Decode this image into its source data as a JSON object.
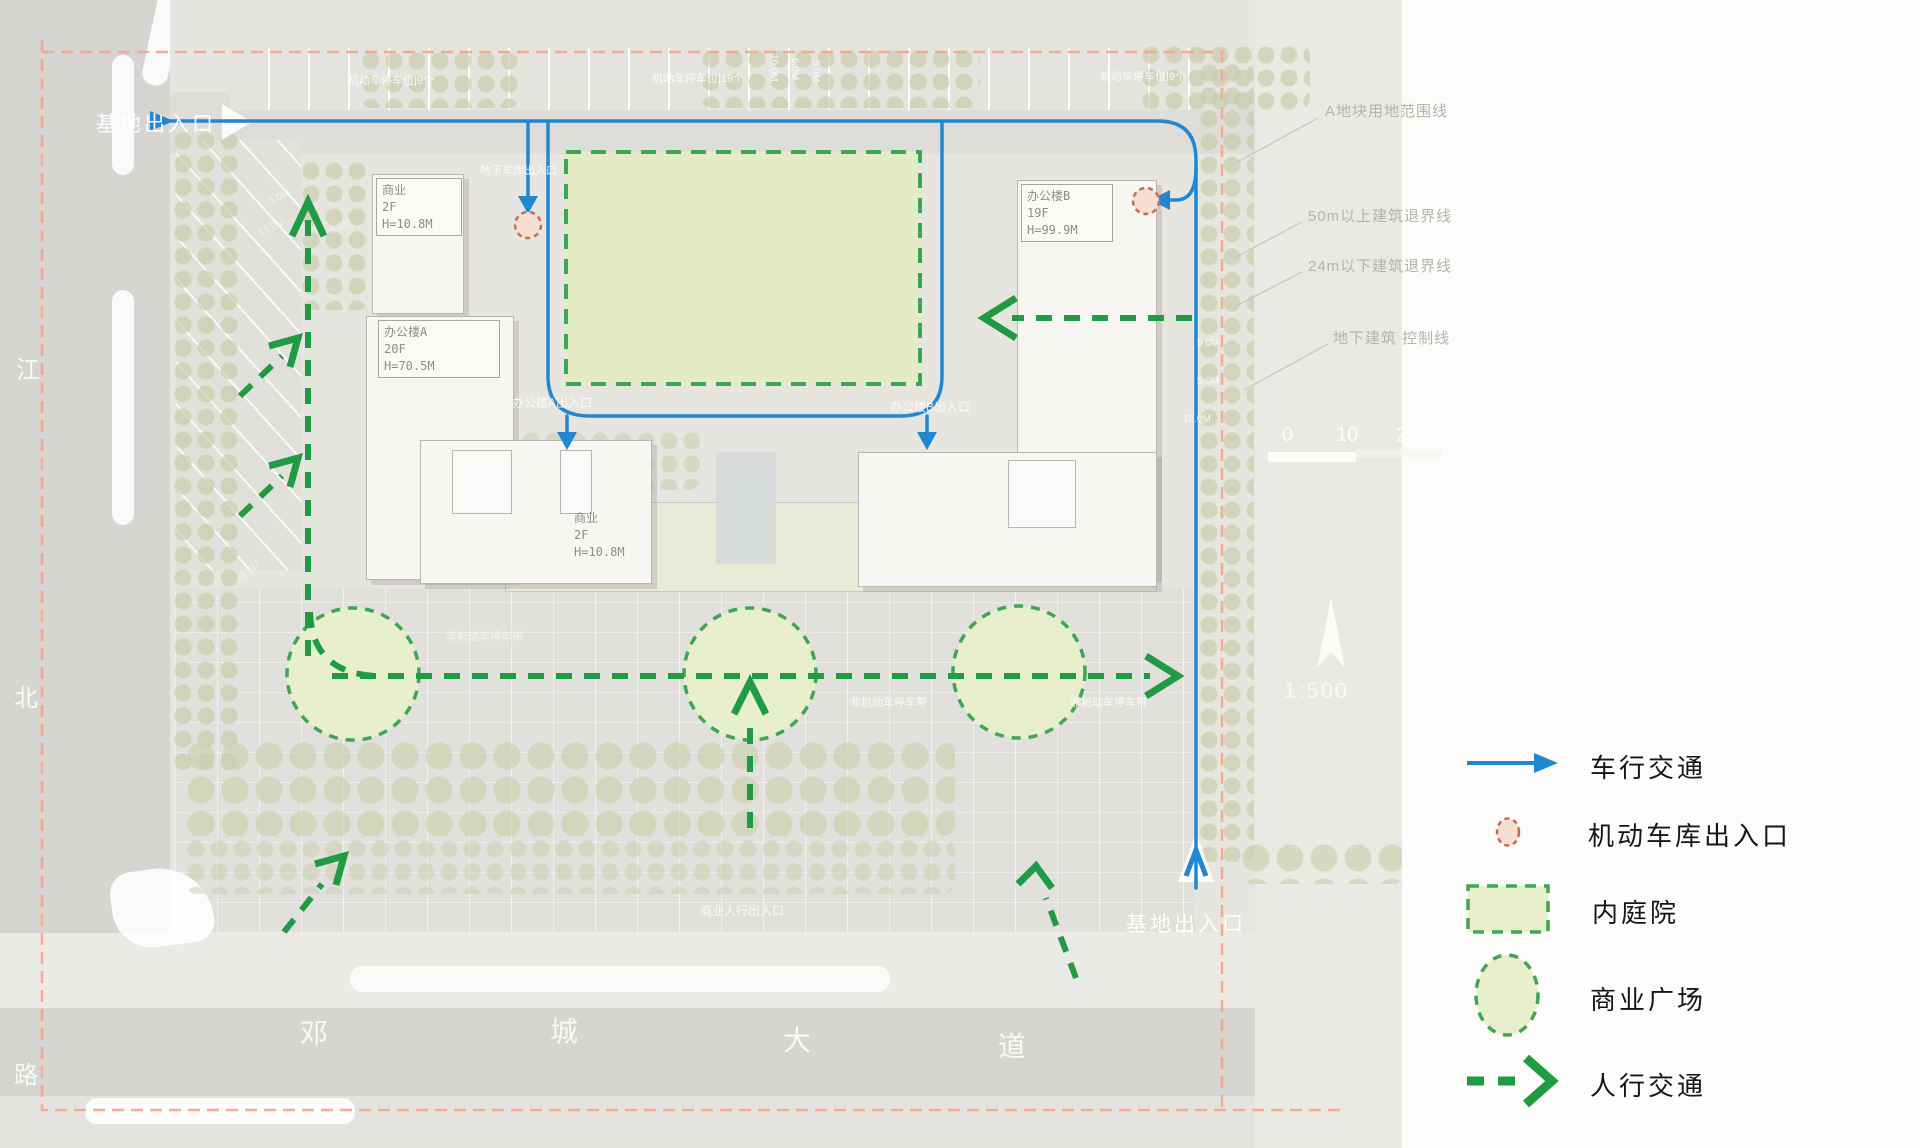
{
  "title": "交通分析总平面图",
  "colors": {
    "vehicle_blue": "#2287cf",
    "pedestrian_green": "#219a44",
    "boundary_orange": "#f2a98b",
    "garage_red": "#cb6950",
    "courtyard_fill": "#e4ecc6",
    "plaza_fill": "#e8efcd"
  },
  "plan": {
    "site_entry_top": "基地出入口",
    "site_entry_bottom": "基地出入口",
    "garage_entry_label": "地下车库出入口",
    "office_a_entry": "办公楼A出入口",
    "office_b_entry": "办公楼B出入口",
    "parking_left": "机动车停车位|9个",
    "parking_mid": "机动车停车位|18个",
    "parking_right": "机动车停车位|9个",
    "bike_parking": "非机动车停车带",
    "shop_ped_entry": "商业人行出入口",
    "road_left_chars": [
      "江",
      "北",
      "路"
    ],
    "road_bottom_chars": [
      "邓",
      "城",
      "大",
      "道"
    ],
    "dims_top": [
      "10.0M",
      "6.0M",
      "5.0M"
    ],
    "dims_left": [
      "5.0M",
      "15.0M",
      "5.0M",
      "5.0M"
    ],
    "dims_right": [
      "5.0M",
      "5.0M",
      "10.0M"
    ],
    "scale_ticks": [
      "0",
      "10",
      "20M"
    ],
    "scale_ratio": "1:500"
  },
  "buildings": [
    {
      "id": "shop-a",
      "lines": [
        "商业",
        "2F",
        "H=10.8M"
      ]
    },
    {
      "id": "office-a",
      "lines": [
        "办公楼A",
        "20F",
        "H=70.5M"
      ]
    },
    {
      "id": "office-b",
      "lines": [
        "办公楼B",
        "19F",
        "H=99.9M"
      ]
    },
    {
      "id": "shop-b",
      "lines": [
        "商业",
        "2F",
        "H=10.8M"
      ]
    }
  ],
  "annotations": [
    {
      "label": "A地块用地范围线"
    },
    {
      "label": "50m以上建筑退界线"
    },
    {
      "label": "24m以下建筑退界线"
    },
    {
      "label": "地下建筑 控制线"
    }
  ],
  "legend": {
    "items": [
      {
        "symbol": "blue-arrow",
        "label": "车行交通"
      },
      {
        "symbol": "red-dashed-circle",
        "label": "机动车库出入口"
      },
      {
        "symbol": "green-dashed-rect",
        "label": "内庭院"
      },
      {
        "symbol": "green-dashed-circle",
        "label": "商业广场"
      },
      {
        "symbol": "green-dashed-arrow",
        "label": "人行交通"
      }
    ]
  }
}
